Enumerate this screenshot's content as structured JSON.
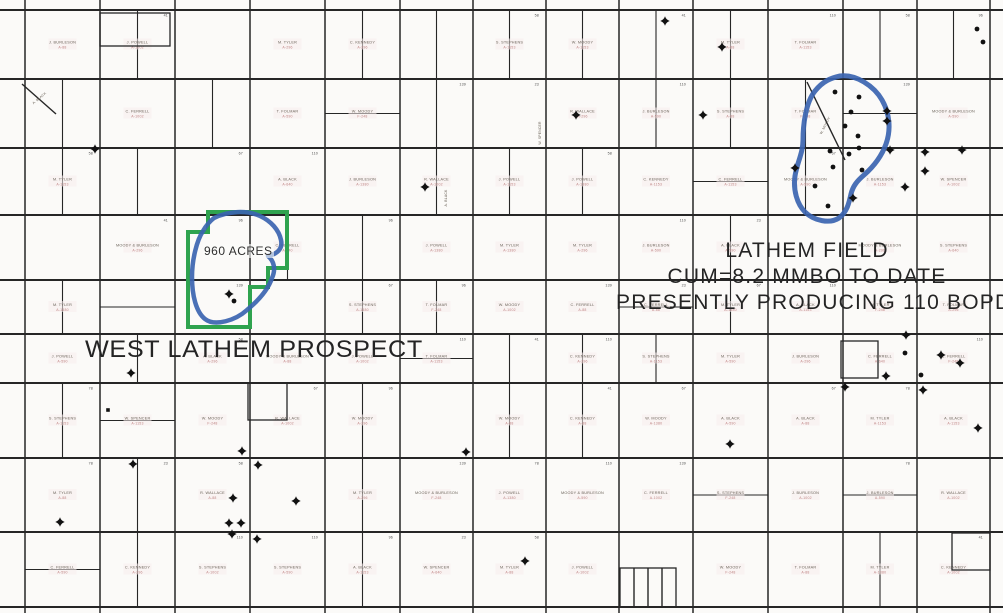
{
  "map": {
    "annotations": {
      "prospect_title": "WEST LATHEM PROSPECT",
      "acreage": "960 ACRES",
      "field_lines": [
        "LATHEM FIELD",
        "CUM=8.2 MMBO TO DATE",
        "PRESENTLY PRODUCING 110 BOPD"
      ]
    },
    "colors": {
      "lease_outline_green": "#2fa34f",
      "field_outline_blue": "#3b64b0",
      "grid_line": "#262626",
      "paper": "#fbfaf8",
      "owner_ink": "#6a6258",
      "tract_ink": "#bf8484",
      "well_ink": "#111111"
    },
    "grid": {
      "columns": [
        25,
        100,
        175,
        250,
        325,
        400,
        473,
        546,
        619,
        693,
        768,
        843,
        917,
        990
      ],
      "rows": [
        10,
        79,
        148,
        215,
        280,
        334,
        383,
        458,
        532,
        607
      ],
      "insets": [
        [
          248,
          383,
          39,
          37
        ],
        [
          841,
          341,
          37,
          37
        ],
        [
          952,
          533,
          38,
          37
        ],
        [
          100,
          13,
          70,
          33
        ],
        [
          620,
          568,
          56,
          39
        ]
      ],
      "extra_lines": [
        [
          634,
          568,
          634,
          607
        ],
        [
          648,
          568,
          648,
          607
        ],
        [
          662,
          568,
          662,
          607
        ],
        [
          22,
          84,
          56,
          114
        ],
        [
          807,
          82,
          845,
          160
        ]
      ]
    },
    "outlines": {
      "lease_polygon": [
        [
          208,
          212
        ],
        [
          287,
          212
        ],
        [
          287,
          268
        ],
        [
          268,
          268
        ],
        [
          268,
          287
        ],
        [
          250,
          287
        ],
        [
          250,
          327
        ],
        [
          188,
          327
        ],
        [
          188,
          232
        ],
        [
          208,
          232
        ]
      ],
      "prospect_blob": "M 214,218 C 228,211 247,210 260,216 C 271,221 279,230 281,240 C 283,249 277,254 268,256 C 274,261 276,269 272,278 C 268,290 259,300 247,310 C 236,320 215,327 205,319 C 196,312 192,295 192,277 C 192,259 197,240 203,231 C 207,224 210,221 214,218 Z",
      "field_blob": "M 840,76 C 856,74 874,86 882,100 C 890,114 891,130 886,144 C 881,158 872,168 864,175 C 857,181 853,186 851,194 C 849,203 847,212 839,218 C 830,224 814,221 805,212 C 797,204 793,190 795,176 C 797,163 803,153 803,140 C 803,124 806,102 815,91 C 823,81 831,78 840,76 Z"
    },
    "wells": {
      "producing_dots": [
        [
          835,
          92
        ],
        [
          859,
          97
        ],
        [
          851,
          112
        ],
        [
          845,
          126
        ],
        [
          858,
          136
        ],
        [
          859,
          148
        ],
        [
          830,
          151
        ],
        [
          849,
          154
        ],
        [
          833,
          167
        ],
        [
          862,
          170
        ],
        [
          815,
          186
        ],
        [
          828,
          206
        ],
        [
          905,
          353
        ],
        [
          921,
          375
        ],
        [
          977,
          29
        ],
        [
          983,
          42
        ],
        [
          234,
          301
        ]
      ],
      "dry_hole_stars": [
        [
          95,
          149
        ],
        [
          576,
          115
        ],
        [
          665,
          21
        ],
        [
          722,
          47
        ],
        [
          703,
          115
        ],
        [
          425,
          187
        ],
        [
          229,
          294
        ],
        [
          131,
          373
        ],
        [
          258,
          465
        ],
        [
          466,
          452
        ],
        [
          133,
          464
        ],
        [
          242,
          451
        ],
        [
          233,
          498
        ],
        [
          296,
          501
        ],
        [
          60,
          522
        ],
        [
          229,
          523
        ],
        [
          241,
          523
        ],
        [
          232,
          534
        ],
        [
          257,
          539
        ],
        [
          525,
          561
        ],
        [
          887,
          111
        ],
        [
          887,
          121
        ],
        [
          890,
          150
        ],
        [
          925,
          152
        ],
        [
          962,
          150
        ],
        [
          795,
          168
        ],
        [
          925,
          171
        ],
        [
          905,
          187
        ],
        [
          853,
          198
        ],
        [
          906,
          335
        ],
        [
          941,
          355
        ],
        [
          960,
          363
        ],
        [
          886,
          376
        ],
        [
          923,
          390
        ],
        [
          845,
          387
        ],
        [
          978,
          428
        ],
        [
          730,
          444
        ]
      ],
      "square_markers": [
        [
          108,
          410
        ]
      ]
    },
    "parcel_texture": {
      "owner_name_pool": [
        "W. SPENCER",
        "C. KENNEDY",
        "J. BURLESON",
        "T. FOLMAR",
        "S. STEPHENS",
        "W. MOODY",
        "R. WALLACE",
        "MOODY & BURLESON",
        "J. POWELL",
        "C. FERRELL",
        "A. BLACK",
        "M. TYLER"
      ],
      "tract_number_pool": [
        "A-1380",
        "A-640",
        "A-590",
        "F-248",
        "A-1153",
        "A-88",
        "A-296",
        "A-1002"
      ],
      "corner_number_pool": [
        "78",
        "58",
        "110",
        "139",
        "41",
        "96",
        "23",
        "67"
      ],
      "rotated_labels": [
        [
          447,
          198,
          -90
        ],
        [
          541,
          133,
          -90
        ],
        [
          40,
          99,
          -40
        ],
        [
          826,
          126,
          -63
        ]
      ]
    }
  }
}
